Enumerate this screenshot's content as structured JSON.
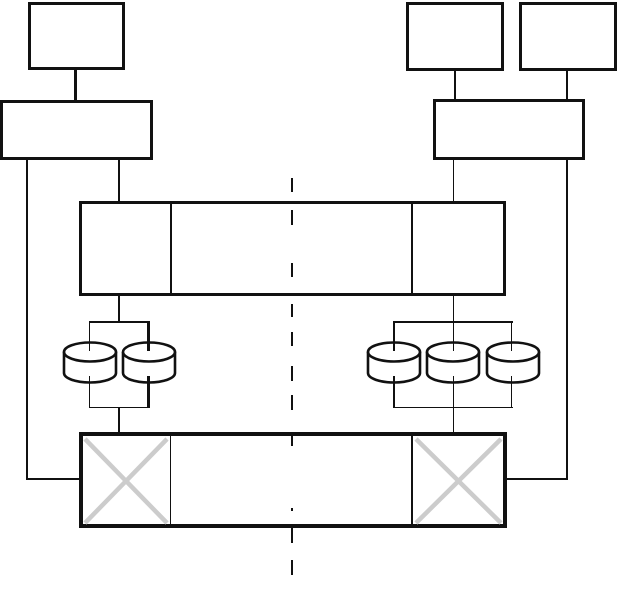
{
  "meta": {
    "type": "block-diagram",
    "background": "#ffffff",
    "visible_text": ""
  },
  "palette": {
    "stroke": "#111111",
    "fill": "#ffffff",
    "cross": "#cccccc"
  },
  "diagram": {
    "width": 624,
    "height": 596,
    "boxes": [
      {
        "name": "top-left-upper-box",
        "x": 28,
        "y": 2,
        "w": 97,
        "h": 68,
        "bw": 3
      },
      {
        "name": "top-left-lower-box",
        "x": 0,
        "y": 100,
        "w": 153,
        "h": 60,
        "bw": 3
      },
      {
        "name": "top-right-upper-box-1",
        "x": 406,
        "y": 2,
        "w": 98,
        "h": 69,
        "bw": 3
      },
      {
        "name": "top-right-upper-box-2",
        "x": 519,
        "y": 2,
        "w": 98,
        "h": 69,
        "bw": 3
      },
      {
        "name": "top-right-lower-box",
        "x": 433,
        "y": 99,
        "w": 152,
        "h": 61,
        "bw": 3
      },
      {
        "name": "upper-bus-box",
        "x": 79,
        "y": 201,
        "w": 427,
        "h": 95,
        "bw": 3
      },
      {
        "name": "lower-bus-box",
        "x": 79,
        "y": 432,
        "w": 428,
        "h": 96,
        "bw": 4
      }
    ],
    "lines": [
      {
        "name": "connector-top-left",
        "x": 74,
        "y": 70,
        "w": 2.5,
        "h": 30
      },
      {
        "name": "left-outer-drop-vertical",
        "x": 26,
        "y": 160,
        "w": 1.5,
        "h": 319
      },
      {
        "name": "left-outer-drop-horizontal",
        "x": 26,
        "y": 478,
        "w": 55,
        "h": 1.5
      },
      {
        "name": "left-inner-drop",
        "x": 117.5,
        "y": 160,
        "w": 2.5,
        "h": 42
      },
      {
        "name": "connector-top-right-1",
        "x": 454,
        "y": 71,
        "w": 1.5,
        "h": 28
      },
      {
        "name": "connector-top-right-2",
        "x": 566,
        "y": 71,
        "w": 1.5,
        "h": 28
      },
      {
        "name": "right-inner-drop",
        "x": 452.5,
        "y": 160,
        "w": 1.5,
        "h": 42
      },
      {
        "name": "right-outer-drop-vertical",
        "x": 566,
        "y": 160,
        "w": 1.5,
        "h": 319
      },
      {
        "name": "right-outer-drop-horizontal",
        "x": 505,
        "y": 478,
        "w": 62.5,
        "h": 1.5
      },
      {
        "name": "upper-bus-divider-left",
        "x": 170,
        "y": 203,
        "w": 1.5,
        "h": 91
      },
      {
        "name": "upper-bus-divider-right",
        "x": 411,
        "y": 203,
        "w": 1.5,
        "h": 91
      },
      {
        "name": "lower-bus-divider-left",
        "x": 169.5,
        "y": 435,
        "w": 1.5,
        "h": 90
      },
      {
        "name": "lower-bus-divider-right",
        "x": 411,
        "y": 435,
        "w": 1.5,
        "h": 90
      },
      {
        "name": "left-bus-to-bracket",
        "x": 117.5,
        "y": 295,
        "w": 2.5,
        "h": 27
      },
      {
        "name": "left-bracket-top",
        "x": 88.5,
        "y": 321,
        "w": 61,
        "h": 1.5
      },
      {
        "name": "left-bracket-bottom",
        "x": 88.5,
        "y": 406.5,
        "w": 61,
        "h": 1.5
      },
      {
        "name": "left-bracket-to-lower-bus",
        "x": 117.5,
        "y": 407,
        "w": 2.5,
        "h": 25
      },
      {
        "name": "right-bus-to-bracket",
        "x": 452.5,
        "y": 295,
        "w": 1.5,
        "h": 27
      },
      {
        "name": "right-bracket-top",
        "x": 392.5,
        "y": 321,
        "w": 120,
        "h": 1.5
      },
      {
        "name": "right-bracket-bottom",
        "x": 392.5,
        "y": 406.5,
        "w": 120,
        "h": 1.5
      },
      {
        "name": "right-bracket-to-lower-bus",
        "x": 452.5,
        "y": 407,
        "w": 1.5,
        "h": 25
      }
    ],
    "overlay_lines": [
      {
        "name": "left-disk-stub-top-1",
        "x": 88.75,
        "y": 322,
        "w": 1.5,
        "h": 29
      },
      {
        "name": "left-disk-stub-top-2",
        "x": 147.25,
        "y": 322,
        "w": 2.5,
        "h": 29
      },
      {
        "name": "left-disk-stub-bottom-1",
        "x": 88.75,
        "y": 376,
        "w": 1.5,
        "h": 31
      },
      {
        "name": "left-disk-stub-bottom-2",
        "x": 147.25,
        "y": 376,
        "w": 2.5,
        "h": 31
      },
      {
        "name": "right-disk-stub-top-1",
        "x": 392.5,
        "y": 322,
        "w": 2,
        "h": 29
      },
      {
        "name": "right-disk-stub-top-2",
        "x": 452.5,
        "y": 322,
        "w": 1.5,
        "h": 29
      },
      {
        "name": "right-disk-stub-top-3",
        "x": 510.75,
        "y": 322,
        "w": 1.5,
        "h": 29
      },
      {
        "name": "right-disk-stub-bottom-1",
        "x": 392.5,
        "y": 376,
        "w": 2,
        "h": 31
      },
      {
        "name": "right-disk-stub-bottom-2",
        "x": 452.5,
        "y": 376,
        "w": 1.5,
        "h": 31
      },
      {
        "name": "right-disk-stub-bottom-3",
        "x": 510.75,
        "y": 376,
        "w": 1.5,
        "h": 31
      }
    ],
    "cylinders": [
      {
        "name": "disk-cylinder-left-1",
        "cx": 89.5,
        "top": 340
      },
      {
        "name": "disk-cylinder-left-2",
        "cx": 148.5,
        "top": 340
      },
      {
        "name": "disk-cylinder-right-1",
        "cx": 393.5,
        "top": 340
      },
      {
        "name": "disk-cylinder-right-2",
        "cx": 452.5,
        "top": 340
      },
      {
        "name": "disk-cylinder-right-3",
        "cx": 512.5,
        "top": 340
      }
    ],
    "crosses": [
      {
        "name": "crossed-out-section-left",
        "x": 83,
        "y": 437,
        "w": 86,
        "h": 88
      },
      {
        "name": "crossed-out-section-right",
        "x": 414,
        "y": 437,
        "w": 89,
        "h": 88
      }
    ],
    "dashed_divider": {
      "name": "center-dashed-divider",
      "x": 291,
      "w": 1.6,
      "segments": [
        [
          178,
          192
        ],
        [
          210,
          225
        ],
        [
          263,
          277
        ],
        [
          304,
          317
        ],
        [
          332,
          346
        ],
        [
          366,
          381
        ],
        [
          395,
          410
        ],
        [
          436,
          446
        ],
        [
          508,
          510.5
        ],
        [
          528,
          543
        ],
        [
          560,
          575
        ]
      ]
    }
  }
}
